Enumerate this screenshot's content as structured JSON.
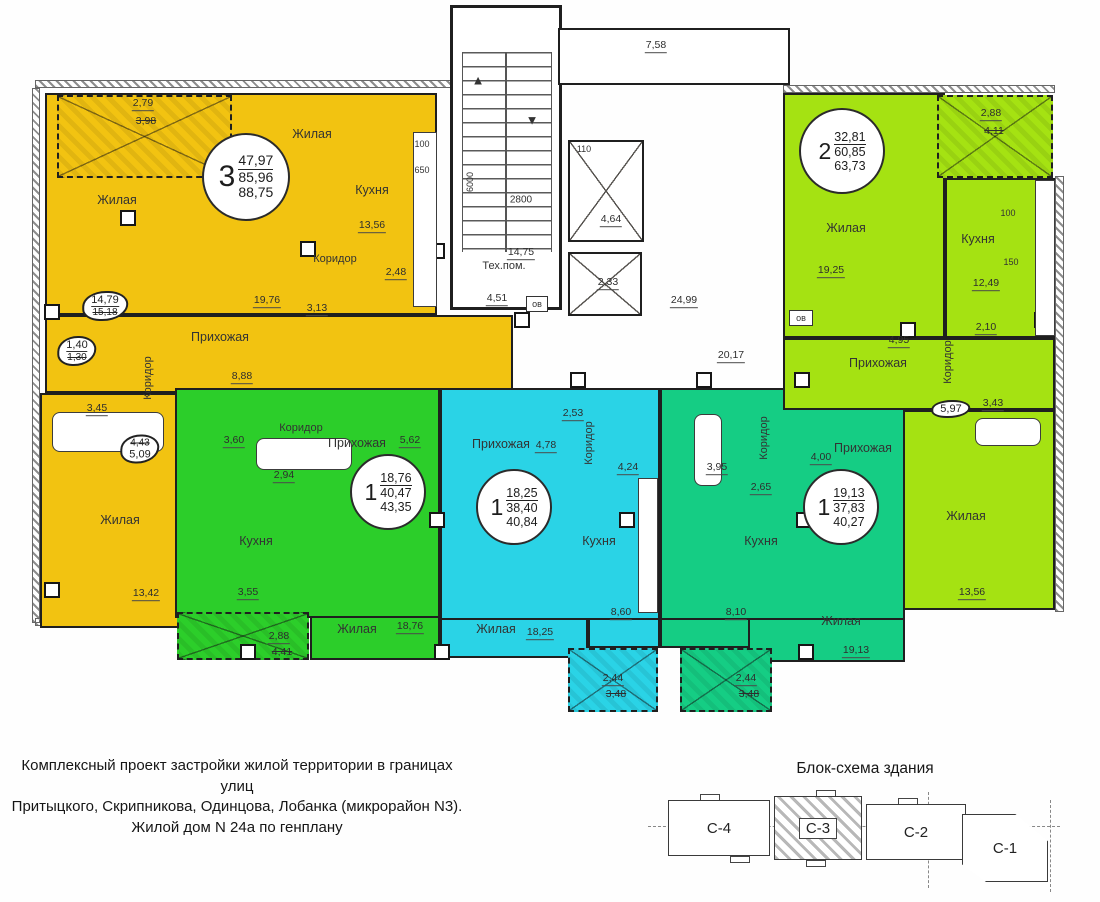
{
  "colors": {
    "apt_orange": "#F2C311",
    "apt_green": "#2CCE2A",
    "apt_cyan": "#2AD3E6",
    "apt_teal": "#15CD84",
    "apt_lime": "#A5E212",
    "walls": "#1F1F1F"
  },
  "plan": {
    "apartments": [
      {
        "id": "3-room-orange",
        "badge": {
          "rooms": "3",
          "living": "47,97",
          "heated": "85,96",
          "total": "88,75"
        },
        "labels": {
          "balcony_new": "2,79",
          "balcony_old": "3,98",
          "living_top": "Жилая",
          "living_left": "Жилая",
          "living_bottom": "Жилая",
          "living_bottom_area": "13,42",
          "kitchen": "Кухня",
          "kitchen_area": "13,56",
          "appl_100": "100",
          "appl_650": "650",
          "corridor_a": "Коридор",
          "corridor_b": "Коридор",
          "wc_area": "2,48",
          "dim_19_76": "19,76",
          "dim_3_13": "3,13",
          "hall": "Прихожая",
          "hall_area": "8,88",
          "fix1_new": "14,79",
          "fix1_old": "15,18",
          "fix2_new": "1,40",
          "fix2_old": "1,30",
          "bath_area": "3,45",
          "fix3_old": "4,43",
          "fix3_new": "5,09"
        }
      },
      {
        "id": "1-room-green",
        "badge": {
          "rooms": "1",
          "living": "18,76",
          "heated": "40,47",
          "total": "43,35"
        },
        "labels": {
          "corridor": "Коридор",
          "corridor_area": "3,60",
          "hall": "Прихожая",
          "hall_area": "5,62",
          "dim_2_94": "2,94",
          "kitchen": "Кухня",
          "dim_3_55": "3,55",
          "balcony_new": "2,88",
          "balcony_old": "4,41",
          "living": "Жилая",
          "living_area": "18,76"
        }
      },
      {
        "id": "1-room-cyan",
        "badge": {
          "rooms": "1",
          "living": "18,25",
          "heated": "38,40",
          "total": "40,84"
        },
        "labels": {
          "hall": "Прихожая",
          "hall_area": "4,78",
          "dim_2_53": "2,53",
          "corridor": "Коридор",
          "bath_area": "4,24",
          "kitchen": "Кухня",
          "kitchen_area": "8,60",
          "living": "Жилая",
          "living_area": "18,25",
          "balcony_new": "2,44",
          "balcony_old": "3,48"
        }
      },
      {
        "id": "1-room-teal",
        "badge": {
          "rooms": "1",
          "living": "19,13",
          "heated": "37,83",
          "total": "40,27"
        },
        "labels": {
          "corridor": "Коридор",
          "bath_area": "3,95",
          "dim_2_65": "2,65",
          "dim_4_00": "4,00",
          "hall": "Прихожая",
          "kitchen": "Кухня",
          "kitchen_area": "8,10",
          "living": "Жилая",
          "living_area": "19,13",
          "balcony_new": "2,44",
          "balcony_old": "3,48"
        }
      },
      {
        "id": "2-room-lime",
        "badge": {
          "rooms": "2",
          "living": "32,81",
          "heated": "60,85",
          "total": "63,73"
        },
        "labels": {
          "balcony_new": "2,88",
          "balcony_old": "4,11",
          "living_top": "Жилая",
          "living_top_area": "19,25",
          "kitchen": "Кухня",
          "kitchen_area": "12,49",
          "appl_100": "100",
          "appl_150": "150",
          "ov": "ов",
          "hall": "Прихожая",
          "hall_area": "4,95",
          "corridor": "Коридор",
          "dim_2_10": "2,10",
          "fix_new": "5,97",
          "bath_area": "3,43",
          "living_bottom": "Жилая",
          "living_bottom_area": "13,56"
        }
      }
    ],
    "common": {
      "corridor_top": "7,58",
      "stair_width": "6000",
      "stair_depth": "2800",
      "stair_area": "14,75",
      "elev_width": "110",
      "elev1_area": "4,64",
      "elev2_area": "2,33",
      "tech_room": "Тех.пом.",
      "tech_area": "4,51",
      "ov": "ов",
      "hall_area_1": "24,99",
      "hall_area_2": "20,17",
      "stair_up": "▲",
      "stair_down": "▼"
    }
  },
  "footer": {
    "line1": "Комплексный проект застройки жилой территории в границах улиц",
    "line2": "Притыцкого, Скрипникова, Одинцова, Лобанка (микрорайон N3).",
    "line3": "Жилой дом N 24а по генплану"
  },
  "scheme": {
    "title": "Блок-схема здания",
    "blocks": [
      {
        "label": "С-4"
      },
      {
        "label": "С-3"
      },
      {
        "label": "С-2"
      },
      {
        "label": "С-1"
      }
    ]
  }
}
